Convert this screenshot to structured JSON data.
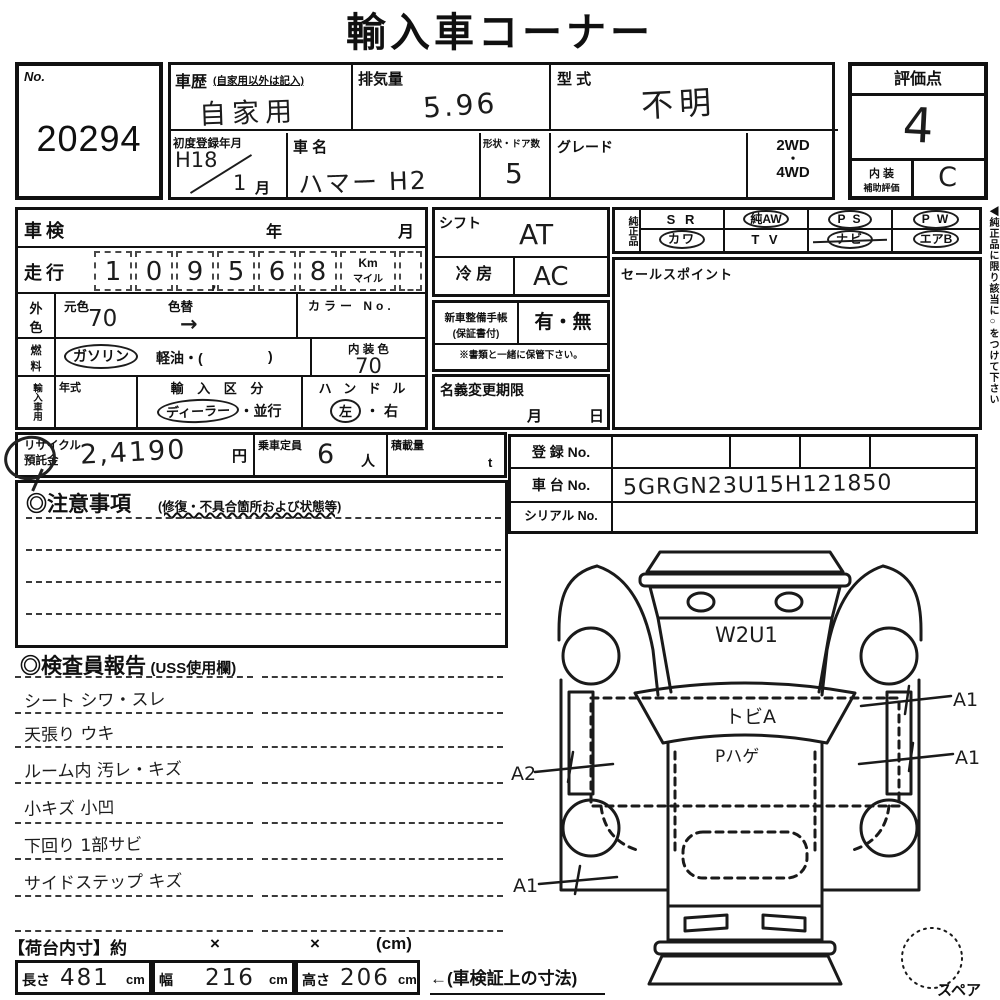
{
  "title": "輸入車コーナー",
  "no_box": {
    "label": "No.",
    "value": "20294"
  },
  "head": {
    "history_label": "車歴",
    "history_note": "(自家用以外は記入)",
    "history_value": "自家用",
    "disp_label": "排気量",
    "disp_value": "5.96",
    "model_label": "型 式",
    "model_value": "不明",
    "firstreg_label": "初度登録年月",
    "firstreg_era": "H18",
    "firstreg_num": "1",
    "firstreg_month": "月",
    "name_label": "車 名",
    "name_value": "ハマー H2",
    "shape_label": "形状・ドア数",
    "shape_value": "5",
    "grade_label": "グレード",
    "wd2": "2WD",
    "wd_dot": "・",
    "wd4": "4WD"
  },
  "rating": {
    "header": "評価点",
    "score": "4",
    "interior1": "内 装",
    "interior2": "補助評価",
    "interior_score": "C"
  },
  "left": {
    "shaken": "車検",
    "year": "年",
    "month": "月",
    "mileage_label": "走行",
    "digits": [
      "1",
      "0",
      "9",
      "5",
      "6",
      "8"
    ],
    "comma": ",",
    "km": "Km",
    "mile": "マイル",
    "outer1": "外",
    "outer2": "色",
    "base_label": "元色",
    "base_value": "70",
    "repaint_label": "色替",
    "repaint_arrow": "→",
    "colorno_label": "カラー No.",
    "fuel1": "燃",
    "fuel2": "料",
    "gasoline": "ガソリン",
    "diesel": "軽油・(",
    "diesel_close": ")",
    "intcolor_label": "内 装 色",
    "intcolor_value": "70",
    "import_header": "輸入車用",
    "year_label": "年式",
    "importclass_label": "輸 入 区 分",
    "dealer": "ディーラー",
    "parallel": "・並行",
    "handle_label": "ハ ン ド ル",
    "handle_left": "左",
    "handle_dot": "・",
    "handle_right": "右"
  },
  "mid": {
    "shift_label": "シフト",
    "shift_value": "AT",
    "ac_label": "冷 房",
    "ac_value": "AC",
    "book1": "新車整備手帳",
    "book2": "(保証書付)",
    "book_value": "有・無",
    "book_note": "※書類と一緒に保管下さい。",
    "namechange_label": "名義変更期限",
    "nc_month": "月",
    "nc_day": "日"
  },
  "genuine": {
    "header": "純正品",
    "r1c1": "S R",
    "r1c2": "純AW",
    "r1c3": "P S",
    "r1c4": "P W",
    "r2c1": "カワ",
    "r2c2": "T V",
    "r2c3": "ナビ",
    "r2c4": "エアB"
  },
  "sales": {
    "label": "セールスポイント"
  },
  "side_note": "◀純正品に限り該当に○をつけて下さい",
  "recycle": {
    "label1": "リサイクル",
    "label2": "預託金",
    "value": "2,4190",
    "yen": "円",
    "capacity_label": "乗車定員",
    "capacity_value": "6",
    "nin": "人",
    "load_label": "積載量",
    "ton": "t"
  },
  "reg": {
    "reg_label": "登 録 No.",
    "chassis_label": "車 台 No.",
    "chassis_value": "5GRGN23U15H121850",
    "serial_label": "シリアル No."
  },
  "cautions": {
    "header": "◎注意事項",
    "note": "(修復・不具合箇所および状態等)"
  },
  "report": {
    "header": "◎検査員報告",
    "note": "(USS使用欄)",
    "lines": [
      "シート シワ・スレ",
      "天張り ウキ",
      "ルーム内 汚レ・キズ",
      "小キズ 小凹",
      "下回り 1部サビ",
      "サイドステップ キズ"
    ]
  },
  "diagram": {
    "hood": "W2U1",
    "windshield": "トビA",
    "roof": "Pハゲ",
    "left_upper": "A2",
    "left_lower": "A1",
    "right_upper": "A1",
    "right_lower": "A1",
    "spare": "スペア"
  },
  "dims": {
    "header": "【荷台内寸】約",
    "x1": "×",
    "x2": "×",
    "cm_paren": "(cm)",
    "len_label": "長さ",
    "len_value": "481",
    "len_unit": "cm",
    "wid_label": "幅",
    "wid_value": "216",
    "wid_unit": "cm",
    "hei_label": "高さ",
    "hei_value": "206",
    "hei_unit": "cm",
    "arrow_note": "←(車検証上の寸法)"
  },
  "ink_color": "#1c1c1c"
}
